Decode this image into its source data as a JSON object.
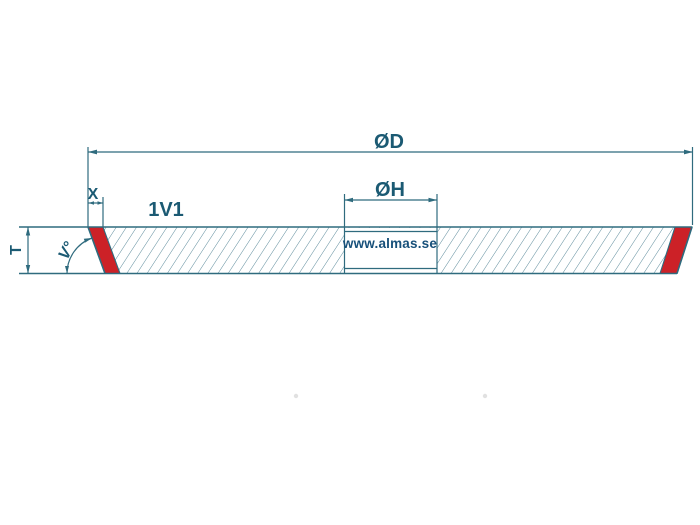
{
  "diagram": {
    "type_label": "1V1",
    "watermark": "www.almas.se",
    "dimensions": {
      "outer_diameter": "ØD",
      "hole_diameter": "ØH",
      "rim_width": "X",
      "thickness": "T",
      "angle": "V°"
    },
    "colors": {
      "line": "#2F6B7E",
      "hatch": "#5E8C9C",
      "label": "#1B5A73",
      "watermark": "#17507A",
      "abrasive": "#CC2127",
      "background": "#FFFFFF",
      "dot": "#BDBDBD"
    }
  }
}
